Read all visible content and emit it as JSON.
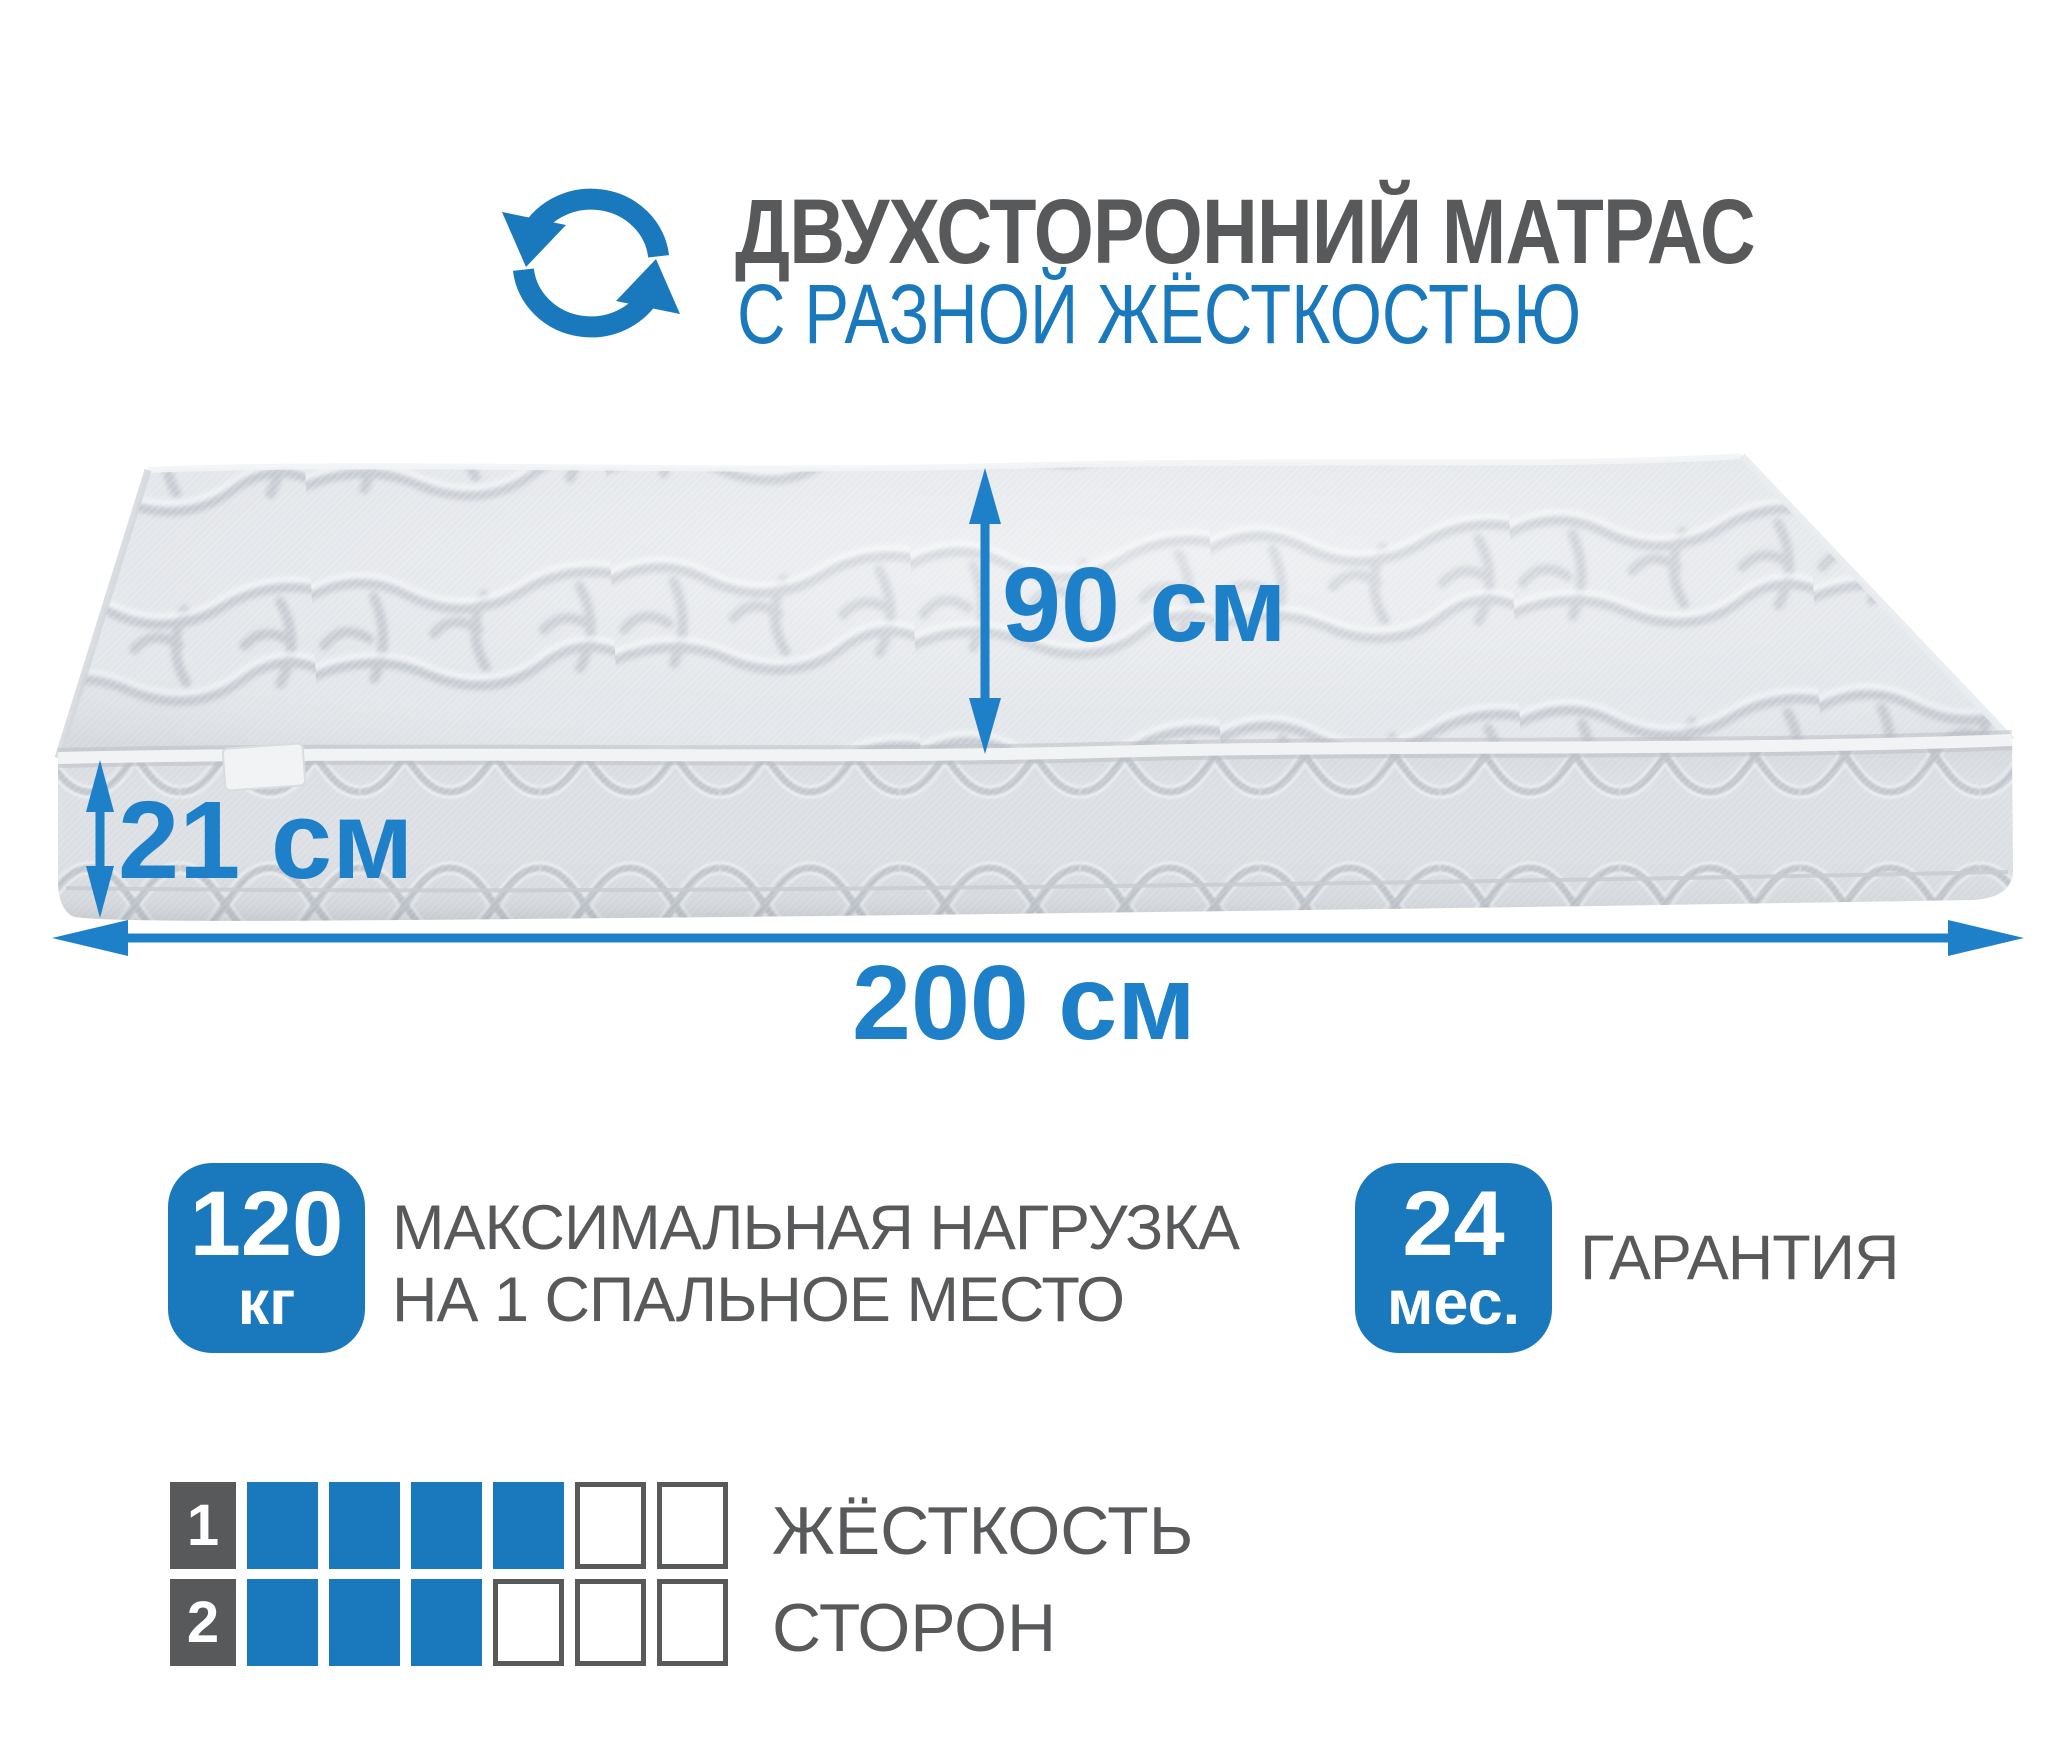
{
  "colors": {
    "accent": "#1A78BC",
    "arrow_blue": "#1E80C8",
    "dark_text": "#58595B"
  },
  "header": {
    "icon": "rotate-double-sided-icon",
    "title": "ДВУХСТОРОННИЙ МАТРАС",
    "subtitle": "С РАЗНОЙ ЖЁСТКОСТЬЮ"
  },
  "diagram": {
    "illustration": "quilted-mattress-perspective",
    "sleeping_width_label": "90 см",
    "thickness_label": "21 см",
    "length_label": "200 см"
  },
  "features": {
    "max_load": {
      "value": "120",
      "unit": "кг",
      "line1": "МАКСИМАЛЬНАЯ НАГРУЗКА",
      "line2": "НА 1 СПАЛЬНОЕ МЕСТО"
    },
    "warranty": {
      "value": "24",
      "unit": "мес.",
      "label": "ГАРАНТИЯ"
    }
  },
  "hardness": {
    "rows": [
      {
        "number": "1",
        "filled": 4,
        "total": 6
      },
      {
        "number": "2",
        "filled": 3,
        "total": 6
      }
    ],
    "caption_line1": "ЖЁСТКОСТЬ",
    "caption_line2": "СТОРОН"
  }
}
